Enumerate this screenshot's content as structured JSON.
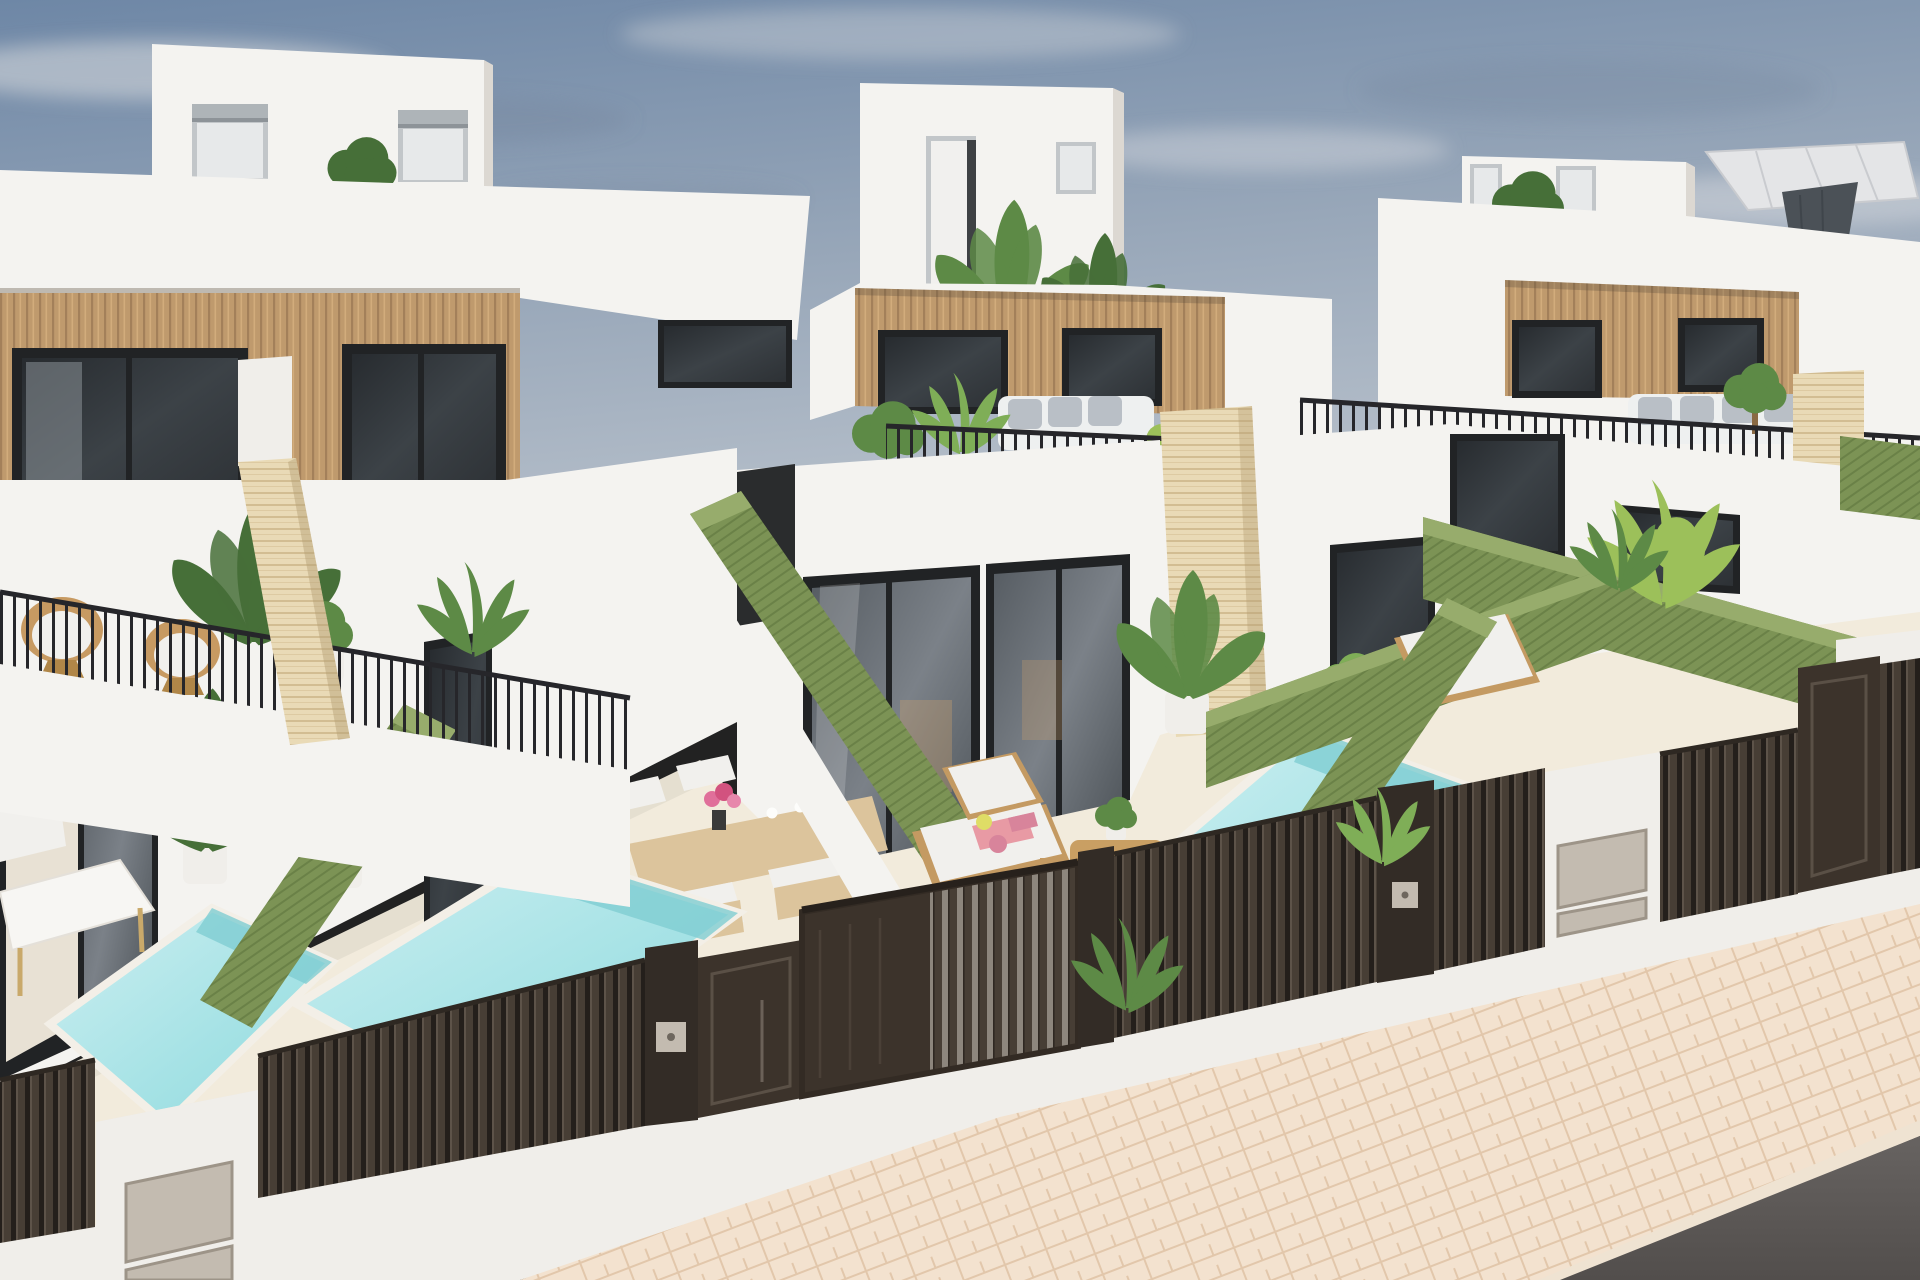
{
  "scene": {
    "title": "Aerial 3D render of new-build white villas with private pools",
    "description": "Photorealistic architectural visualization: a row of modern two-storey white townhouse villas with roof-top rooms and terraces, vertical wood-slat facade bands, black-framed glazing, black metal terrace railings, rattan chairs, white outdoor sofas, a grey cantilever parasol, travertine stone pillars, green hedge walls dividing cream-tiled patios, turquoise plunge pools, sun loungers with pink towels, a wooden dining set with pink flowers, dark-brown slatted street fences and gates with entry pillars and metal utility doors, a pale herringbone-paved sidewalk and an asphalt road in the foreground under a blue sky with wispy clouds.",
    "sky": {
      "clouds": "wispy",
      "birds": 1
    },
    "buildings": [
      {
        "id": "left-villa",
        "features": [
          "rooftop-box-with-two-shuttered-windows",
          "wood-slat-facade-band",
          "two-dark-glass-sliders",
          "roof-terrace-black-railing",
          "two-rattan-chairs",
          "potted-plants",
          "white-and-travertine-pillar",
          "ground-floor-glass-doors",
          "dining-patio",
          "plunge-pool"
        ]
      },
      {
        "id": "center-villa",
        "features": [
          "rooftop-box-with-door-and-plants",
          "wood-slat-facade-band",
          "balcony-with-white-sofa",
          "black-railing",
          "ground-floor-glass-doors",
          "sun-lounger-with-pink-towels",
          "wooden-side-table",
          "travertine-pillar",
          "plunge-pool"
        ]
      },
      {
        "id": "right-villa",
        "features": [
          "rooftop-box-with-windows",
          "grey-cantilever-parasol-roof-terrace",
          "wood-slat-facade-band",
          "balcony-with-white-sofa",
          "black-railing",
          "travertine-pillar",
          "hedged-patio-with-lounger",
          "plunge-pool-sliver"
        ]
      },
      {
        "id": "far-right-villa",
        "features": [
          "white-walls",
          "hedges",
          "slatted-fence"
        ]
      }
    ],
    "landscape": {
      "hedge_walls": 6,
      "pools_visible": 3,
      "patio_floor": "cream stone tiles",
      "plants": [
        "banana-plants",
        "areca-palms",
        "bamboo-palm",
        "boxwood-bushes",
        "lime-green-shrub"
      ]
    },
    "street": {
      "fence": "dark brown vertical-slat aluminium",
      "gates": [
        "sliding-vehicle-gate",
        "pedestrian-door",
        "far-right-gate"
      ],
      "entry_pillars_with_metal_doors": 2,
      "keypads": 2,
      "sidewalk": "pale pink herringbone pavers",
      "road": "dark asphalt"
    }
  },
  "palette": {
    "sky_top": "#6e87a6",
    "sky_mid": "#98a7b9",
    "sky_low": "#c7cdd4",
    "cloud_light": "#d8dadd",
    "cloud_dark": "#76879f",
    "white_wall": "#f4f3f0",
    "white_shade": "#e9e6e1",
    "white_dark": "#dcd8d2",
    "wood": "#bf9a6d",
    "wood_line": "#a3805a",
    "wood_hi": "#d2ac7c",
    "glass_frame": "#212325",
    "glass_dark": "#32363a",
    "glass_mid": "#4a5056",
    "window_frame": "#c2c6c9",
    "window_glass": "#e7e9ea",
    "shutter_gray": "#aeb4b8",
    "hedge": "#7c9355",
    "hedge_line": "#6a8147",
    "hedge_light": "#97ac6c",
    "travertine": "#e9dab6",
    "travertine_line": "#d2bd92",
    "pool_light": "#cdeff1",
    "pool_mid": "#9fdfe2",
    "pool_deep": "#7fcdd2",
    "patio_floor": "#f2ebdc",
    "fence_dark": "#3c332b",
    "fence_slat": "#473e35",
    "fence_gap": "#241f1b",
    "fence_hi": "#5d5349",
    "gate_gap": "#8d867d",
    "post_dark": "#332c26",
    "pillar_white": "#f0eeea",
    "metal_box": "#c3bbb0",
    "sidewalk": "#f3e2cf",
    "sidewalk_line": "#e2c7ab",
    "road": "#5b5755",
    "rattan": "#c79a62",
    "cushion": "#f1f0ed",
    "pillow_gray": "#b9bfc6",
    "sofa_white": "#eef0f0",
    "wood_furniture": "#c49a62",
    "wood_table": "#dcc49c",
    "towel_pink": "#e89aa4",
    "towel_rose": "#d8849b",
    "lime_accent": "#dfdd66",
    "interior_warm": "#caa06d",
    "plant_dark": "#466f38",
    "plant_mid": "#5d8a46",
    "plant_light": "#7fae57",
    "plant_bright": "#9cc05a",
    "umbrella_gray": "#e4e5e7",
    "umbrella_drape": "#4b5157"
  }
}
